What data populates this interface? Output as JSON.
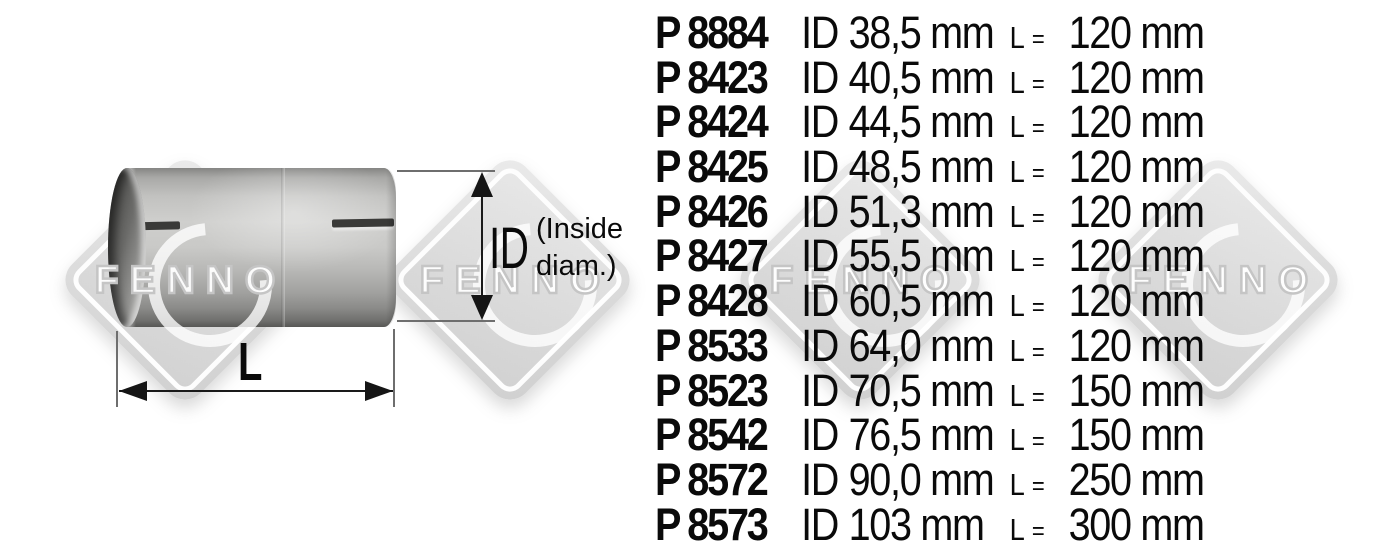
{
  "brand_watermark": {
    "text": "FENNO"
  },
  "diagram": {
    "id_label": "ID",
    "id_note_line1": "(Inside",
    "id_note_line2": "diam.)",
    "length_label": "L"
  },
  "parts_table": {
    "shared": {
      "id_prefix": "ID",
      "length_symbol": "L",
      "equals": "="
    },
    "rows": [
      {
        "part": "P 8884",
        "inner_diameter": "38,5 mm",
        "length": "120 mm"
      },
      {
        "part": "P 8423",
        "inner_diameter": "40,5 mm",
        "length": "120 mm"
      },
      {
        "part": "P 8424",
        "inner_diameter": "44,5 mm",
        "length": "120 mm"
      },
      {
        "part": "P 8425",
        "inner_diameter": "48,5 mm",
        "length": "120 mm"
      },
      {
        "part": "P 8426",
        "inner_diameter": "51,3 mm",
        "length": "120 mm"
      },
      {
        "part": "P 8427",
        "inner_diameter": "55,5 mm",
        "length": "120 mm"
      },
      {
        "part": "P 8428",
        "inner_diameter": "60,5 mm",
        "length": "120 mm"
      },
      {
        "part": "P 8533",
        "inner_diameter": "64,0 mm",
        "length": "120 mm"
      },
      {
        "part": "P 8523",
        "inner_diameter": "70,5 mm",
        "length": "150 mm"
      },
      {
        "part": "P 8542",
        "inner_diameter": "76,5 mm",
        "length": "150 mm"
      },
      {
        "part": "P 8572",
        "inner_diameter": "90,0 mm",
        "length": "250 mm"
      },
      {
        "part": "P 8573",
        "inner_diameter": "103 mm",
        "length": "300 mm"
      }
    ]
  },
  "colors": {
    "text": "#000000",
    "watermark_fill": "#dcdcdc",
    "watermark_outline": "#c5c5c5",
    "metal_light": "#d0d0ce",
    "metal_dark": "#6f6f6d",
    "dimension_line": "#1a1a1a"
  }
}
